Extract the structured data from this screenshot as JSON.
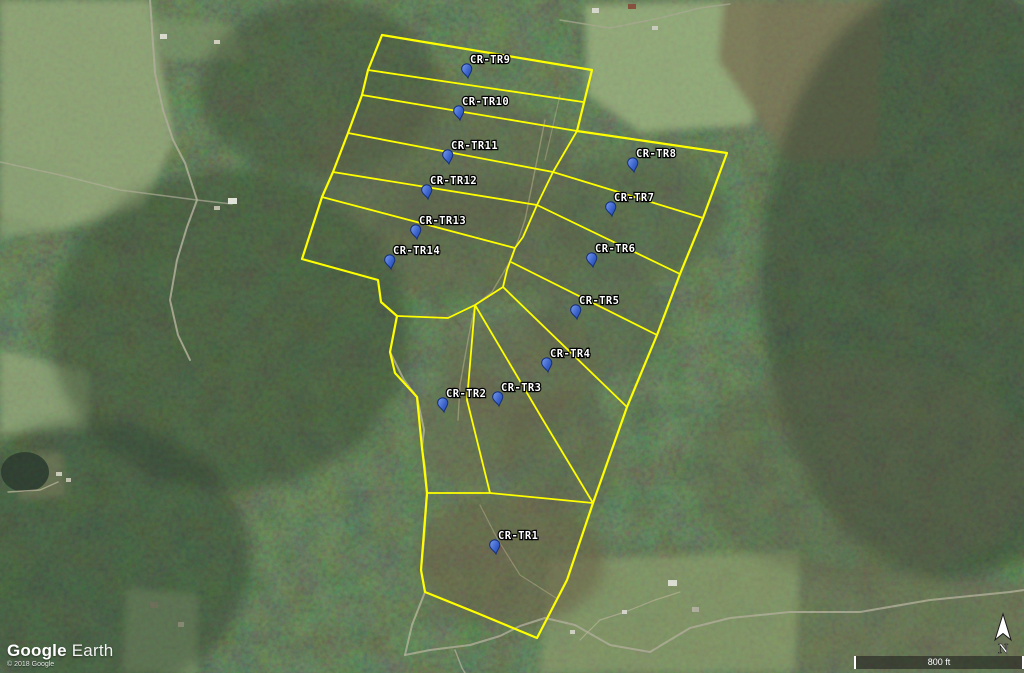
{
  "app": {
    "logo_primary": "Google",
    "logo_secondary": "Earth",
    "copyright": "© 2018 Google"
  },
  "map_controls": {
    "scale_label": "800 ft",
    "north_label": "N"
  },
  "overlay": {
    "boundary_color": "#ffff00",
    "pin_fill": "#4a74d8",
    "pin_edge": "#16307a",
    "label_color": "#ffffff",
    "outer_boundary": [
      [
        382,
        35
      ],
      [
        592,
        70
      ],
      [
        577,
        131
      ],
      [
        727,
        153
      ],
      [
        703,
        218
      ],
      [
        680,
        274
      ],
      [
        657,
        335
      ],
      [
        627,
        407
      ],
      [
        593,
        503
      ],
      [
        567,
        580
      ],
      [
        537,
        638
      ],
      [
        477,
        613
      ],
      [
        425,
        592
      ],
      [
        421,
        570
      ],
      [
        427,
        493
      ],
      [
        424,
        465
      ],
      [
        422,
        448
      ],
      [
        417,
        397
      ],
      [
        395,
        373
      ],
      [
        390,
        352
      ],
      [
        397,
        316
      ],
      [
        381,
        302
      ],
      [
        378,
        280
      ],
      [
        302,
        259
      ],
      [
        322,
        197
      ],
      [
        333,
        172
      ],
      [
        348,
        133
      ],
      [
        362,
        95
      ],
      [
        368,
        70
      ]
    ],
    "tract_lines": [
      {
        "name": "tr9-tr10",
        "points": [
          [
            368,
            70
          ],
          [
            583,
            102
          ]
        ]
      },
      {
        "name": "tr10-tr11",
        "points": [
          [
            362,
            95
          ],
          [
            577,
            131
          ]
        ]
      },
      {
        "name": "tr11-tr12",
        "points": [
          [
            348,
            133
          ],
          [
            553,
            172
          ]
        ]
      },
      {
        "name": "tr12-tr13",
        "points": [
          [
            333,
            172
          ],
          [
            537,
            205
          ]
        ]
      },
      {
        "name": "tr13-tr14",
        "points": [
          [
            322,
            197
          ],
          [
            515,
            248
          ]
        ]
      },
      {
        "name": "central-spine",
        "points": [
          [
            577,
            131
          ],
          [
            553,
            172
          ],
          [
            537,
            205
          ],
          [
            523,
            237
          ],
          [
            515,
            248
          ],
          [
            507,
            270
          ],
          [
            503,
            287
          ],
          [
            475,
            305
          ]
        ]
      },
      {
        "name": "tr8-tr7",
        "points": [
          [
            553,
            172
          ],
          [
            703,
            218
          ]
        ]
      },
      {
        "name": "tr7-tr6",
        "points": [
          [
            537,
            205
          ],
          [
            680,
            274
          ]
        ]
      },
      {
        "name": "tr6-tr5",
        "points": [
          [
            511,
            262
          ],
          [
            657,
            335
          ]
        ]
      },
      {
        "name": "tr5-tr4",
        "points": [
          [
            503,
            287
          ],
          [
            627,
            407
          ]
        ]
      },
      {
        "name": "hub-west",
        "points": [
          [
            397,
            316
          ],
          [
            448,
            318
          ],
          [
            475,
            305
          ]
        ]
      },
      {
        "name": "tr2-tr3",
        "points": [
          [
            475,
            305
          ],
          [
            467,
            400
          ],
          [
            490,
            493
          ]
        ]
      },
      {
        "name": "tr3-tr4",
        "points": [
          [
            475,
            305
          ],
          [
            543,
            420
          ],
          [
            593,
            503
          ]
        ]
      },
      {
        "name": "tr1-north",
        "points": [
          [
            427,
            493
          ],
          [
            490,
            493
          ],
          [
            593,
            503
          ]
        ]
      }
    ],
    "placemarks": [
      {
        "label": "CR-TR1",
        "x": 496,
        "y": 554
      },
      {
        "label": "CR-TR2",
        "x": 444,
        "y": 412
      },
      {
        "label": "CR-TR3",
        "x": 499,
        "y": 406
      },
      {
        "label": "CR-TR4",
        "x": 548,
        "y": 372
      },
      {
        "label": "CR-TR5",
        "x": 577,
        "y": 319
      },
      {
        "label": "CR-TR6",
        "x": 593,
        "y": 267
      },
      {
        "label": "CR-TR7",
        "x": 612,
        "y": 216
      },
      {
        "label": "CR-TR8",
        "x": 634,
        "y": 172
      },
      {
        "label": "CR-TR9",
        "x": 468,
        "y": 78
      },
      {
        "label": "CR-TR10",
        "x": 460,
        "y": 120
      },
      {
        "label": "CR-TR11",
        "x": 449,
        "y": 164
      },
      {
        "label": "CR-TR12",
        "x": 428,
        "y": 199
      },
      {
        "label": "CR-TR13",
        "x": 417,
        "y": 239
      },
      {
        "label": "CR-TR14",
        "x": 391,
        "y": 269
      }
    ]
  },
  "terrain": {
    "base_color": "#46523a",
    "fields": [
      {
        "points": [
          [
            0,
            0
          ],
          [
            150,
            0
          ],
          [
            175,
            140
          ],
          [
            143,
            207
          ],
          [
            60,
            228
          ],
          [
            0,
            215
          ]
        ],
        "color": "#97a97c",
        "opacity": 0.9
      },
      {
        "points": [
          [
            0,
            148
          ],
          [
            58,
            160
          ],
          [
            68,
            228
          ],
          [
            0,
            238
          ]
        ],
        "color": "#8fa276",
        "opacity": 0.8
      },
      {
        "points": [
          [
            0,
            350
          ],
          [
            88,
            372
          ],
          [
            90,
            430
          ],
          [
            0,
            434
          ]
        ],
        "color": "#93a67a",
        "opacity": 0.85
      },
      {
        "points": [
          [
            585,
            5
          ],
          [
            760,
            0
          ],
          [
            753,
            125
          ],
          [
            640,
            132
          ],
          [
            588,
            95
          ]
        ],
        "color": "#9cb080",
        "opacity": 0.9
      },
      {
        "points": [
          [
            724,
            0
          ],
          [
            884,
            0
          ],
          [
            876,
            158
          ],
          [
            788,
            162
          ],
          [
            718,
            60
          ]
        ],
        "color": "#7d7558",
        "opacity": 0.9
      },
      {
        "points": [
          [
            128,
            588
          ],
          [
            198,
            594
          ],
          [
            196,
            673
          ],
          [
            122,
            673
          ]
        ],
        "color": "#94a77b",
        "opacity": 0.85
      },
      {
        "points": [
          [
            548,
            560
          ],
          [
            800,
            552
          ],
          [
            795,
            673
          ],
          [
            540,
            673
          ]
        ],
        "color": "#8d9c6e",
        "opacity": 0.75
      },
      {
        "points": [
          [
            800,
            560
          ],
          [
            1024,
            585
          ],
          [
            1024,
            673
          ],
          [
            795,
            673
          ]
        ],
        "color": "#6c6a4f",
        "opacity": 0.5
      },
      {
        "points": [
          [
            15,
            455
          ],
          [
            62,
            452
          ],
          [
            66,
            496
          ],
          [
            20,
            500
          ]
        ],
        "color": "#b3a77f",
        "opacity": 0.8
      },
      {
        "points": [
          [
            150,
            18
          ],
          [
            235,
            25
          ],
          [
            245,
            60
          ],
          [
            165,
            60
          ]
        ],
        "color": "#879b6e",
        "opacity": 0.6
      }
    ],
    "shades": [
      {
        "cx": 950,
        "cy": 280,
        "rx": 190,
        "ry": 300,
        "color": "#2c382a",
        "opacity": 0.5
      },
      {
        "cx": 230,
        "cy": 330,
        "rx": 180,
        "ry": 160,
        "color": "#31402e",
        "opacity": 0.5
      },
      {
        "cx": 90,
        "cy": 560,
        "rx": 160,
        "ry": 140,
        "color": "#2e3b2b",
        "opacity": 0.5
      },
      {
        "cx": 320,
        "cy": 90,
        "rx": 120,
        "ry": 90,
        "color": "#33422f",
        "opacity": 0.45
      },
      {
        "cx": 445,
        "cy": 165,
        "rx": 130,
        "ry": 75,
        "color": "#5e5c45",
        "opacity": 0.5
      },
      {
        "cx": 480,
        "cy": 240,
        "rx": 110,
        "ry": 60,
        "color": "#5a5843",
        "opacity": 0.45
      },
      {
        "cx": 640,
        "cy": 215,
        "rx": 85,
        "ry": 65,
        "color": "#4f5a42",
        "opacity": 0.5
      },
      {
        "cx": 600,
        "cy": 320,
        "rx": 70,
        "ry": 55,
        "color": "#555c44",
        "opacity": 0.45
      },
      {
        "cx": 520,
        "cy": 370,
        "rx": 80,
        "ry": 55,
        "color": "#665f4a",
        "opacity": 0.5
      },
      {
        "cx": 470,
        "cy": 430,
        "rx": 55,
        "ry": 55,
        "color": "#6a624c",
        "opacity": 0.5
      },
      {
        "cx": 510,
        "cy": 560,
        "rx": 95,
        "ry": 65,
        "color": "#695e46",
        "opacity": 0.6
      },
      {
        "cx": 560,
        "cy": 450,
        "rx": 60,
        "ry": 60,
        "color": "#5f5a45",
        "opacity": 0.45
      },
      {
        "cx": 860,
        "cy": 470,
        "rx": 170,
        "ry": 110,
        "color": "#5a5a45",
        "opacity": 0.35
      }
    ],
    "pond": {
      "cx": 25,
      "cy": 472,
      "rx": 24,
      "ry": 20,
      "color": "#27352b",
      "opacity": 0.95
    },
    "roads": [
      {
        "points": [
          [
            150,
            0
          ],
          [
            155,
            73
          ],
          [
            163,
            110
          ],
          [
            173,
            140
          ],
          [
            185,
            163
          ],
          [
            197,
            200
          ],
          [
            187,
            227
          ],
          [
            177,
            260
          ],
          [
            170,
            300
          ],
          [
            178,
            335
          ],
          [
            190,
            360
          ]
        ],
        "color": "#b5b09c",
        "width": 2,
        "opacity": 0.9
      },
      {
        "points": [
          [
            0,
            162
          ],
          [
            60,
            175
          ],
          [
            120,
            190
          ],
          [
            197,
            200
          ],
          [
            232,
            204
          ]
        ],
        "color": "#b5b09c",
        "width": 1.5,
        "opacity": 0.7
      },
      {
        "points": [
          [
            390,
            352
          ],
          [
            404,
            380
          ],
          [
            417,
            397
          ],
          [
            424,
            430
          ],
          [
            422,
            448
          ],
          [
            425,
            467
          ],
          [
            427,
            493
          ],
          [
            424,
            540
          ],
          [
            421,
            570
          ],
          [
            425,
            592
          ],
          [
            412,
            625
          ],
          [
            405,
            655
          ]
        ],
        "color": "#c0b89f",
        "width": 2,
        "opacity": 0.8
      },
      {
        "points": [
          [
            405,
            655
          ],
          [
            430,
            650
          ],
          [
            470,
            645
          ],
          [
            500,
            636
          ],
          [
            520,
            626
          ],
          [
            545,
            618
          ],
          [
            575,
            625
          ],
          [
            610,
            645
          ],
          [
            650,
            652
          ],
          [
            690,
            628
          ],
          [
            730,
            618
          ],
          [
            790,
            612
          ],
          [
            860,
            612
          ],
          [
            930,
            600
          ],
          [
            1010,
            592
          ],
          [
            1024,
            590
          ]
        ],
        "color": "#b5b09c",
        "width": 2,
        "opacity": 0.85
      },
      {
        "points": [
          [
            455,
            650
          ],
          [
            462,
            668
          ],
          [
            465,
            673
          ]
        ],
        "color": "#b5b09c",
        "width": 1.5,
        "opacity": 0.8
      },
      {
        "points": [
          [
            560,
            20
          ],
          [
            610,
            28
          ],
          [
            660,
            18
          ],
          [
            700,
            8
          ],
          [
            730,
            4
          ]
        ],
        "color": "#b0ab98",
        "width": 1.5,
        "opacity": 0.75
      },
      {
        "points": [
          [
            8,
            492
          ],
          [
            40,
            490
          ],
          [
            58,
            482
          ]
        ],
        "color": "#c0b89f",
        "width": 1.5,
        "opacity": 0.8
      },
      {
        "points": [
          [
            580,
            640
          ],
          [
            600,
            620
          ],
          [
            625,
            612
          ],
          [
            655,
            600
          ],
          [
            680,
            592
          ]
        ],
        "color": "#c0b89f",
        "width": 1.2,
        "opacity": 0.7
      },
      {
        "points": [
          [
            545,
            120
          ],
          [
            535,
            170
          ],
          [
            525,
            220
          ],
          [
            512,
            258
          ],
          [
            492,
            292
          ],
          [
            475,
            305
          ],
          [
            468,
            340
          ],
          [
            460,
            385
          ],
          [
            458,
            420
          ]
        ],
        "color": "#c9bd96",
        "width": 1.4,
        "opacity": 0.5
      },
      {
        "points": [
          [
            480,
            505
          ],
          [
            498,
            540
          ],
          [
            520,
            575
          ],
          [
            556,
            598
          ]
        ],
        "color": "#c9bd96",
        "width": 1.2,
        "opacity": 0.45
      },
      {
        "points": [
          [
            560,
            95
          ],
          [
            552,
            130
          ],
          [
            545,
            160
          ]
        ],
        "color": "#c9bd96",
        "width": 1.2,
        "opacity": 0.45
      }
    ],
    "buildings": [
      {
        "x": 160,
        "y": 34,
        "w": 7,
        "h": 5,
        "color": "#e8e6df"
      },
      {
        "x": 214,
        "y": 40,
        "w": 6,
        "h": 4,
        "color": "#ddd8cc"
      },
      {
        "x": 228,
        "y": 198,
        "w": 9,
        "h": 6,
        "color": "#f0efe8"
      },
      {
        "x": 214,
        "y": 206,
        "w": 6,
        "h": 4,
        "color": "#c9c4b4"
      },
      {
        "x": 56,
        "y": 472,
        "w": 6,
        "h": 4,
        "color": "#d8d3c4"
      },
      {
        "x": 66,
        "y": 478,
        "w": 5,
        "h": 4,
        "color": "#cfc9b8"
      },
      {
        "x": 150,
        "y": 602,
        "w": 8,
        "h": 6,
        "color": "#6e6a58"
      },
      {
        "x": 178,
        "y": 622,
        "w": 6,
        "h": 5,
        "color": "#8a8674"
      },
      {
        "x": 668,
        "y": 580,
        "w": 9,
        "h": 6,
        "color": "#e9e7e0"
      },
      {
        "x": 692,
        "y": 607,
        "w": 7,
        "h": 5,
        "color": "#b9b4a4"
      },
      {
        "x": 622,
        "y": 610,
        "w": 5,
        "h": 4,
        "color": "#e2dfd6"
      },
      {
        "x": 570,
        "y": 630,
        "w": 5,
        "h": 4,
        "color": "#dcd9cf"
      },
      {
        "x": 592,
        "y": 8,
        "w": 7,
        "h": 5,
        "color": "#e6e3da"
      },
      {
        "x": 628,
        "y": 4,
        "w": 8,
        "h": 5,
        "color": "#8a4a3a"
      },
      {
        "x": 652,
        "y": 26,
        "w": 6,
        "h": 4,
        "color": "#d8d5ca"
      }
    ]
  }
}
